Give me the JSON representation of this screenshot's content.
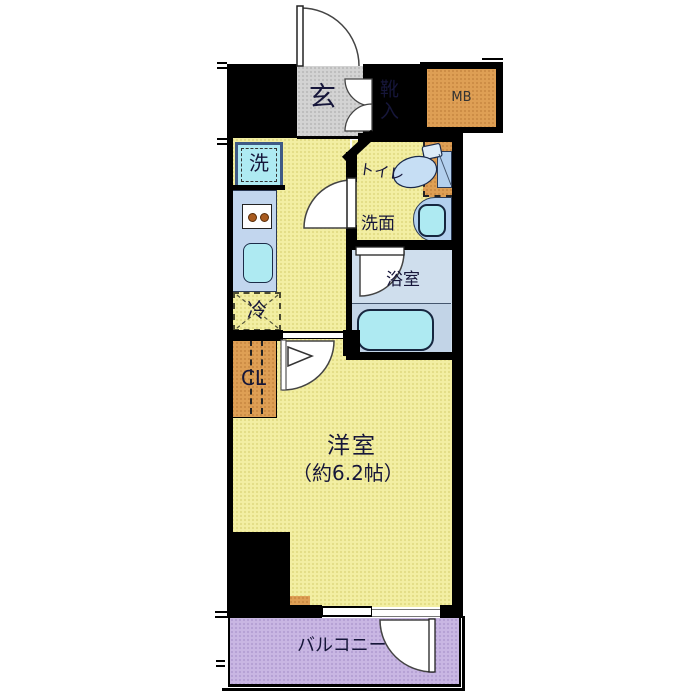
{
  "title": "apartment-floor-plan",
  "labels": {
    "genkan": "玄",
    "shoe_box": "靴入",
    "meter_box": "MB",
    "washer": "洗",
    "fridge": "冷",
    "toilet": "トイレ",
    "washroom": "洗面",
    "bathroom": "浴室",
    "closet": "CL",
    "room_name": "洋室",
    "room_size": "（約6.2帖）",
    "balcony": "バルコニー"
  },
  "colors": {
    "floor_yellow": "#f3efa3",
    "genkan_gray": "#d3d3d3",
    "orange": "#de9f55",
    "cyan": "#aeeaf2",
    "counter_blue": "#c2d6ee",
    "fixture_blue": "#b3d0ee",
    "bath_bg": "#cfdeed",
    "bath_lower": "#c2d4e7",
    "balcony_purple": "#c9b7e3",
    "wall": "#000000",
    "text": "#16163a"
  }
}
